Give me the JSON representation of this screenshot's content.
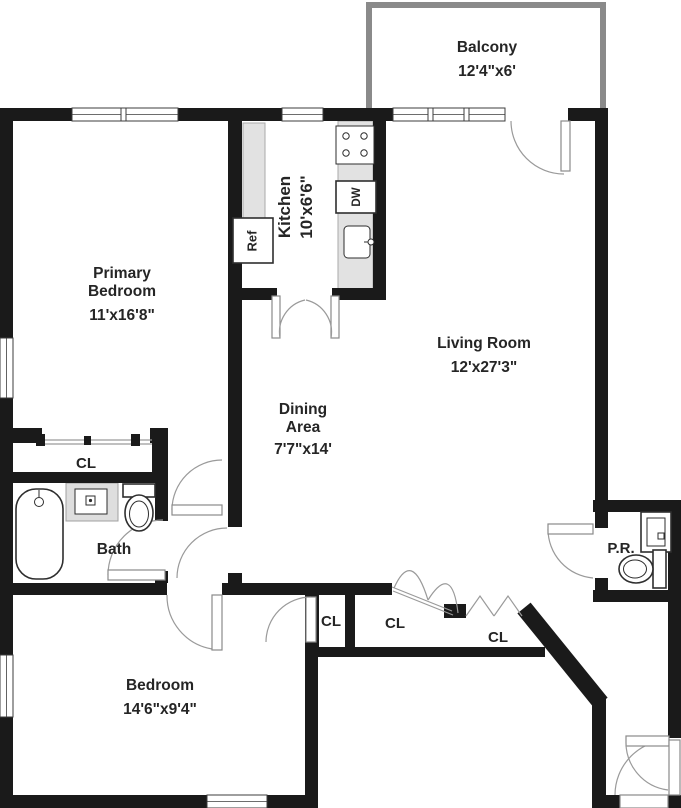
{
  "plan": {
    "colors": {
      "background": "#ffffff",
      "wall": "#1a1a1a",
      "counter": "#e2e2e2",
      "balcony_wall": "#8a8a8a",
      "door": "#9a9a9a"
    },
    "rooms": {
      "balcony": {
        "name": "Balcony",
        "dims": "12'4\"x6'"
      },
      "primary_bedroom": {
        "name_line1": "Primary",
        "name_line2": "Bedroom",
        "dims": "11'x16'8\""
      },
      "kitchen": {
        "name": "Kitchen",
        "dims": "10'x6'6\""
      },
      "living_room": {
        "name": "Living Room",
        "dims": "12'x27'3\""
      },
      "dining_area": {
        "name_line1": "Dining",
        "name_line2": "Area",
        "dims": "7'7\"x14'"
      },
      "bath": {
        "name": "Bath"
      },
      "bedroom": {
        "name": "Bedroom",
        "dims": "14'6\"x9'4\""
      },
      "powder_room": {
        "name": "P.R."
      },
      "closet_hall": {
        "name": "CL"
      },
      "closet_1": {
        "name": "CL"
      },
      "closet_2": {
        "name": "CL"
      },
      "closet_3": {
        "name": "CL"
      }
    },
    "fixtures": {
      "refrigerator": "Ref",
      "dishwasher": "DW"
    }
  }
}
